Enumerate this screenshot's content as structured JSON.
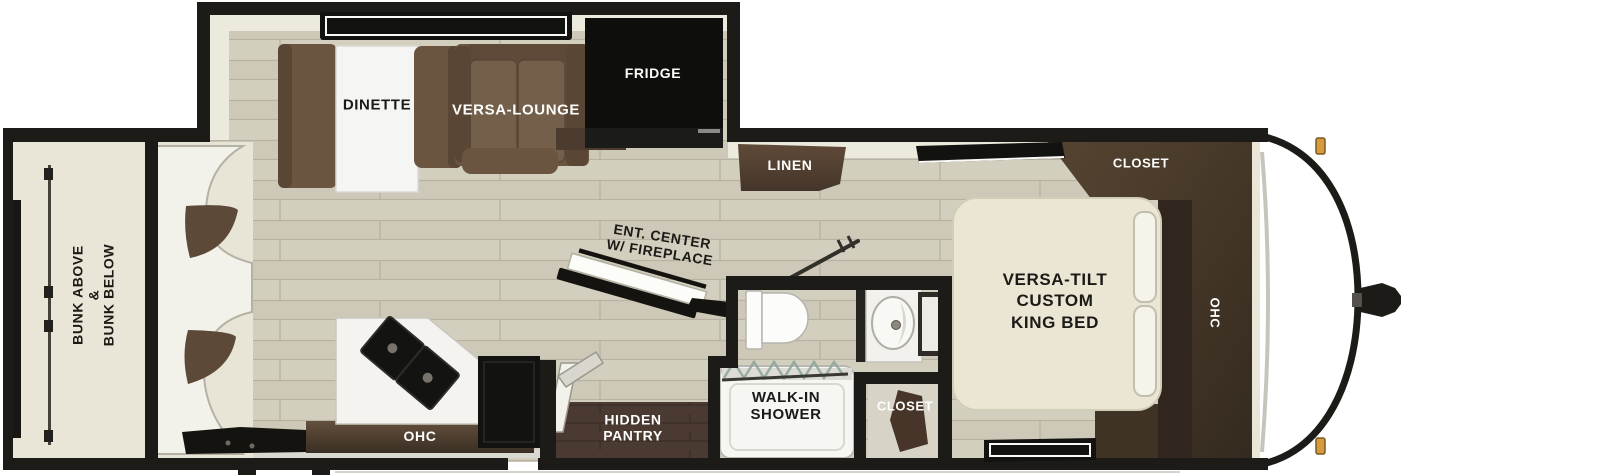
{
  "floorplan": {
    "labels": {
      "bunk": [
        "BUNK ABOVE",
        "&",
        "BUNK BELOW"
      ],
      "dinette": "DINETTE",
      "versa_lounge": "VERSA-LOUNGE",
      "fridge": "FRIDGE",
      "linen": "LINEN",
      "ent_center": [
        "ENT. CENTER",
        "W/ FIREPLACE"
      ],
      "hidden_pantry": [
        "HIDDEN",
        "PANTRY"
      ],
      "walk_in_shower": [
        "WALK-IN",
        "SHOWER"
      ],
      "bath_closet": "CLOSET",
      "kitchen_ohc": "OHC",
      "king_bed": [
        "VERSA-TILT",
        "CUSTOM",
        "KING BED"
      ],
      "bedroom_closet": "CLOSET",
      "bedroom_ohc": "OHC"
    },
    "colors": {
      "wall_black": "#1d1b18",
      "floor_wood": "#cdc8b7",
      "floor_pantry": "#4a3a31",
      "sofa_brown": "#6b5440",
      "cabinet_walnut": "#4a3b2e",
      "bed_cream": "#eae6d3",
      "clearance_light_amber": "#d89a3e"
    }
  }
}
